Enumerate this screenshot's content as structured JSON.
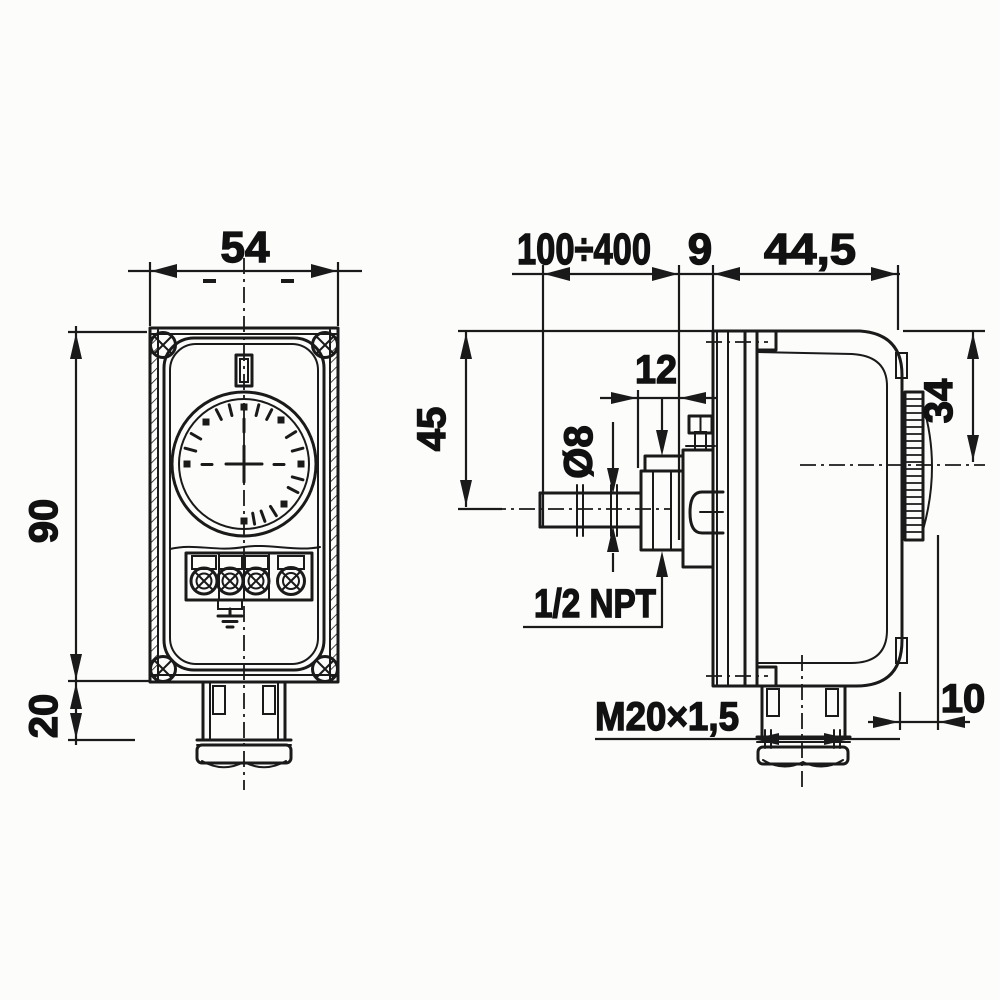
{
  "drawing": {
    "type": "technical-dimension-drawing",
    "subject": "immersion thermostat with enclosure — front view and side view with dimensions (mm)",
    "front_view": {
      "width": "54",
      "height": "90",
      "gland_height": "20"
    },
    "side_view": {
      "immersion_length": "100÷400",
      "neck_width": "9",
      "housing_depth": "44,5",
      "bushing_length": "12",
      "top_to_probe_axis": "45",
      "probe_diameter": "Ø8",
      "process_thread": "1/2 NPT",
      "top_to_knob_axis": "34",
      "knob_protrusion": "10",
      "cable_gland_thread": "M20×1,5"
    },
    "colors": {
      "line": "#1a1a1a",
      "background": "#fcfcfb"
    }
  }
}
